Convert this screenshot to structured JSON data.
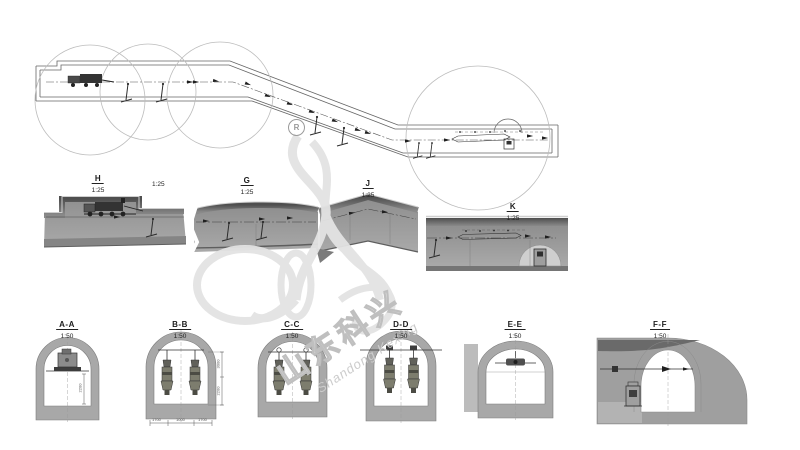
{
  "watermark": {
    "cn": "山东科兴",
    "en": "Shandong Kexing",
    "registered": "R"
  },
  "sections": [
    {
      "label": "H",
      "scale": "1:25",
      "extra_scale": "1:25"
    },
    {
      "label": "G",
      "scale": "1:25"
    },
    {
      "label": "J",
      "scale": "1:25"
    },
    {
      "label": "K",
      "scale": "1:25"
    }
  ],
  "cross_sections": [
    {
      "label": "A-A",
      "scale": "1:50",
      "dim_right": "2200"
    },
    {
      "label": "B-B",
      "scale": "1:50",
      "dim_right_upper": "3000",
      "dim_right_lower": "2200",
      "dim_bottom_left": "1700",
      "dim_bottom_mid": "1000",
      "dim_bottom_right": "1700"
    },
    {
      "label": "C-C",
      "scale": "1:50"
    },
    {
      "label": "D-D",
      "scale": "1:50"
    },
    {
      "label": "E-E",
      "scale": "1:50"
    },
    {
      "label": "F-F",
      "scale": "1:50"
    }
  ],
  "colors": {
    "section_fill": "#9e9e9e",
    "section_top": "#666666",
    "ring_fill": "#a8a8a8",
    "line": "#555555",
    "watermark": "#e3e3e3"
  }
}
